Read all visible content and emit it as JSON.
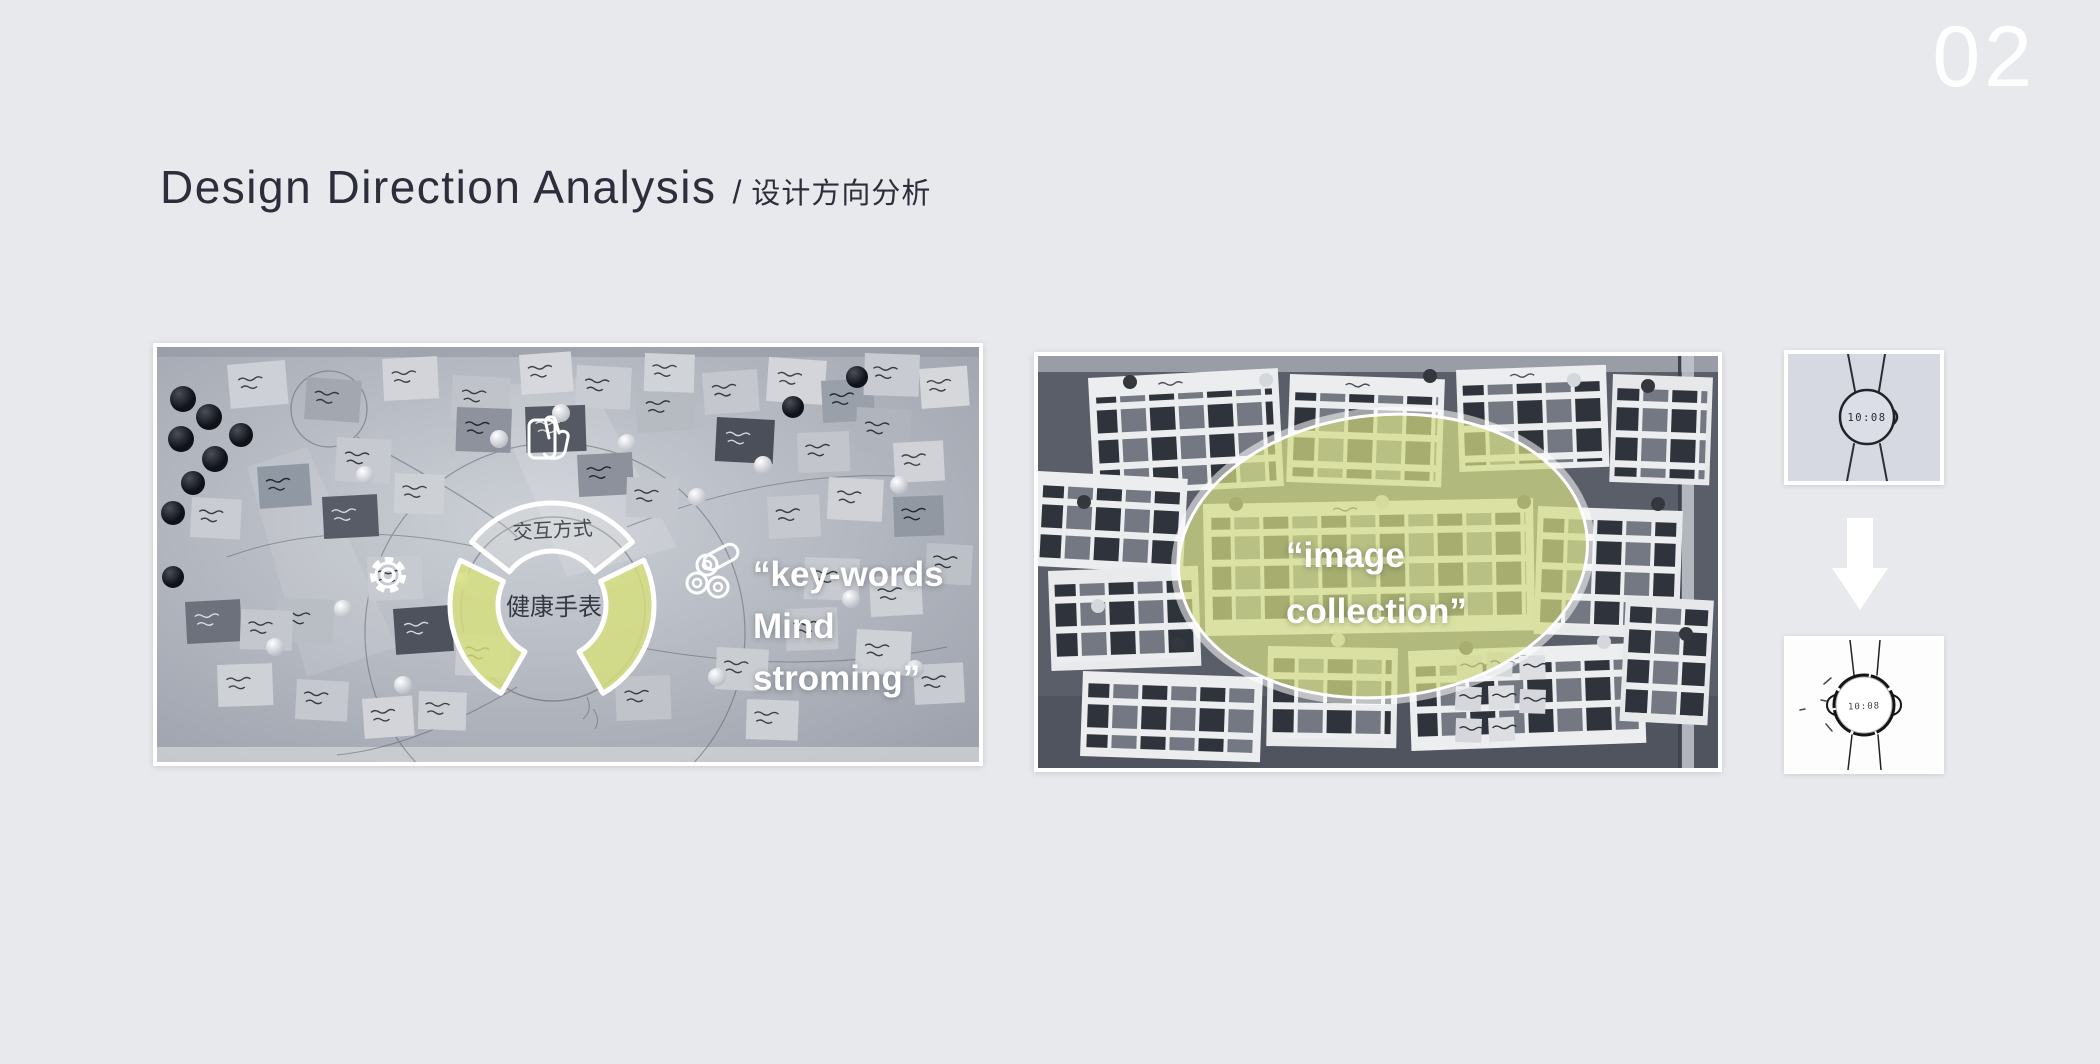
{
  "slide": {
    "page_number": "02",
    "background_color": "#e8e9ed"
  },
  "header": {
    "title_en": "Design Direction Analysis",
    "separator": "/",
    "title_zh": "设计方向分析",
    "title_color": "#2c2e3c"
  },
  "mindmap_photo": {
    "description": "grayscale whiteboard mind-map photo with sticky notes",
    "center_label": "健康手表",
    "top_arc_label": "交互方式",
    "caption_lines": [
      "“key-words",
      "Mind",
      "stroming”"
    ],
    "highlight_color": "#d7e17c",
    "icons": [
      "tap-gesture-icon",
      "gear-icon",
      "cells-icon"
    ]
  },
  "moodboard_photo": {
    "description": "grayscale mood board photo of product images",
    "caption_lines": [
      "“image",
      "collection”"
    ],
    "highlight_color": "#d4dd84"
  },
  "watch_sequence": {
    "top_watch_time": "10:08",
    "bottom_watch_time": "10:08",
    "arrow_direction": "down"
  }
}
